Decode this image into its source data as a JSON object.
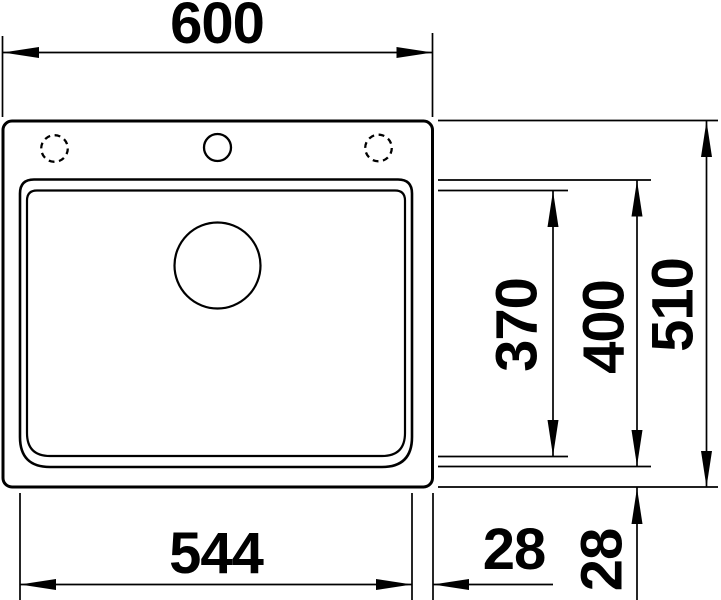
{
  "drawing": {
    "subject": "sink-dimension-drawing",
    "view": "top-view",
    "colors": {
      "line": "#000000",
      "background": "#ffffff"
    },
    "dimensions": {
      "overall_width": "600",
      "overall_depth": "510",
      "bowl_outer_depth": "400",
      "bowl_inner_depth": "370",
      "bowl_width": "544",
      "right_edge_gap": "28",
      "bottom_edge_gap": "28"
    }
  }
}
